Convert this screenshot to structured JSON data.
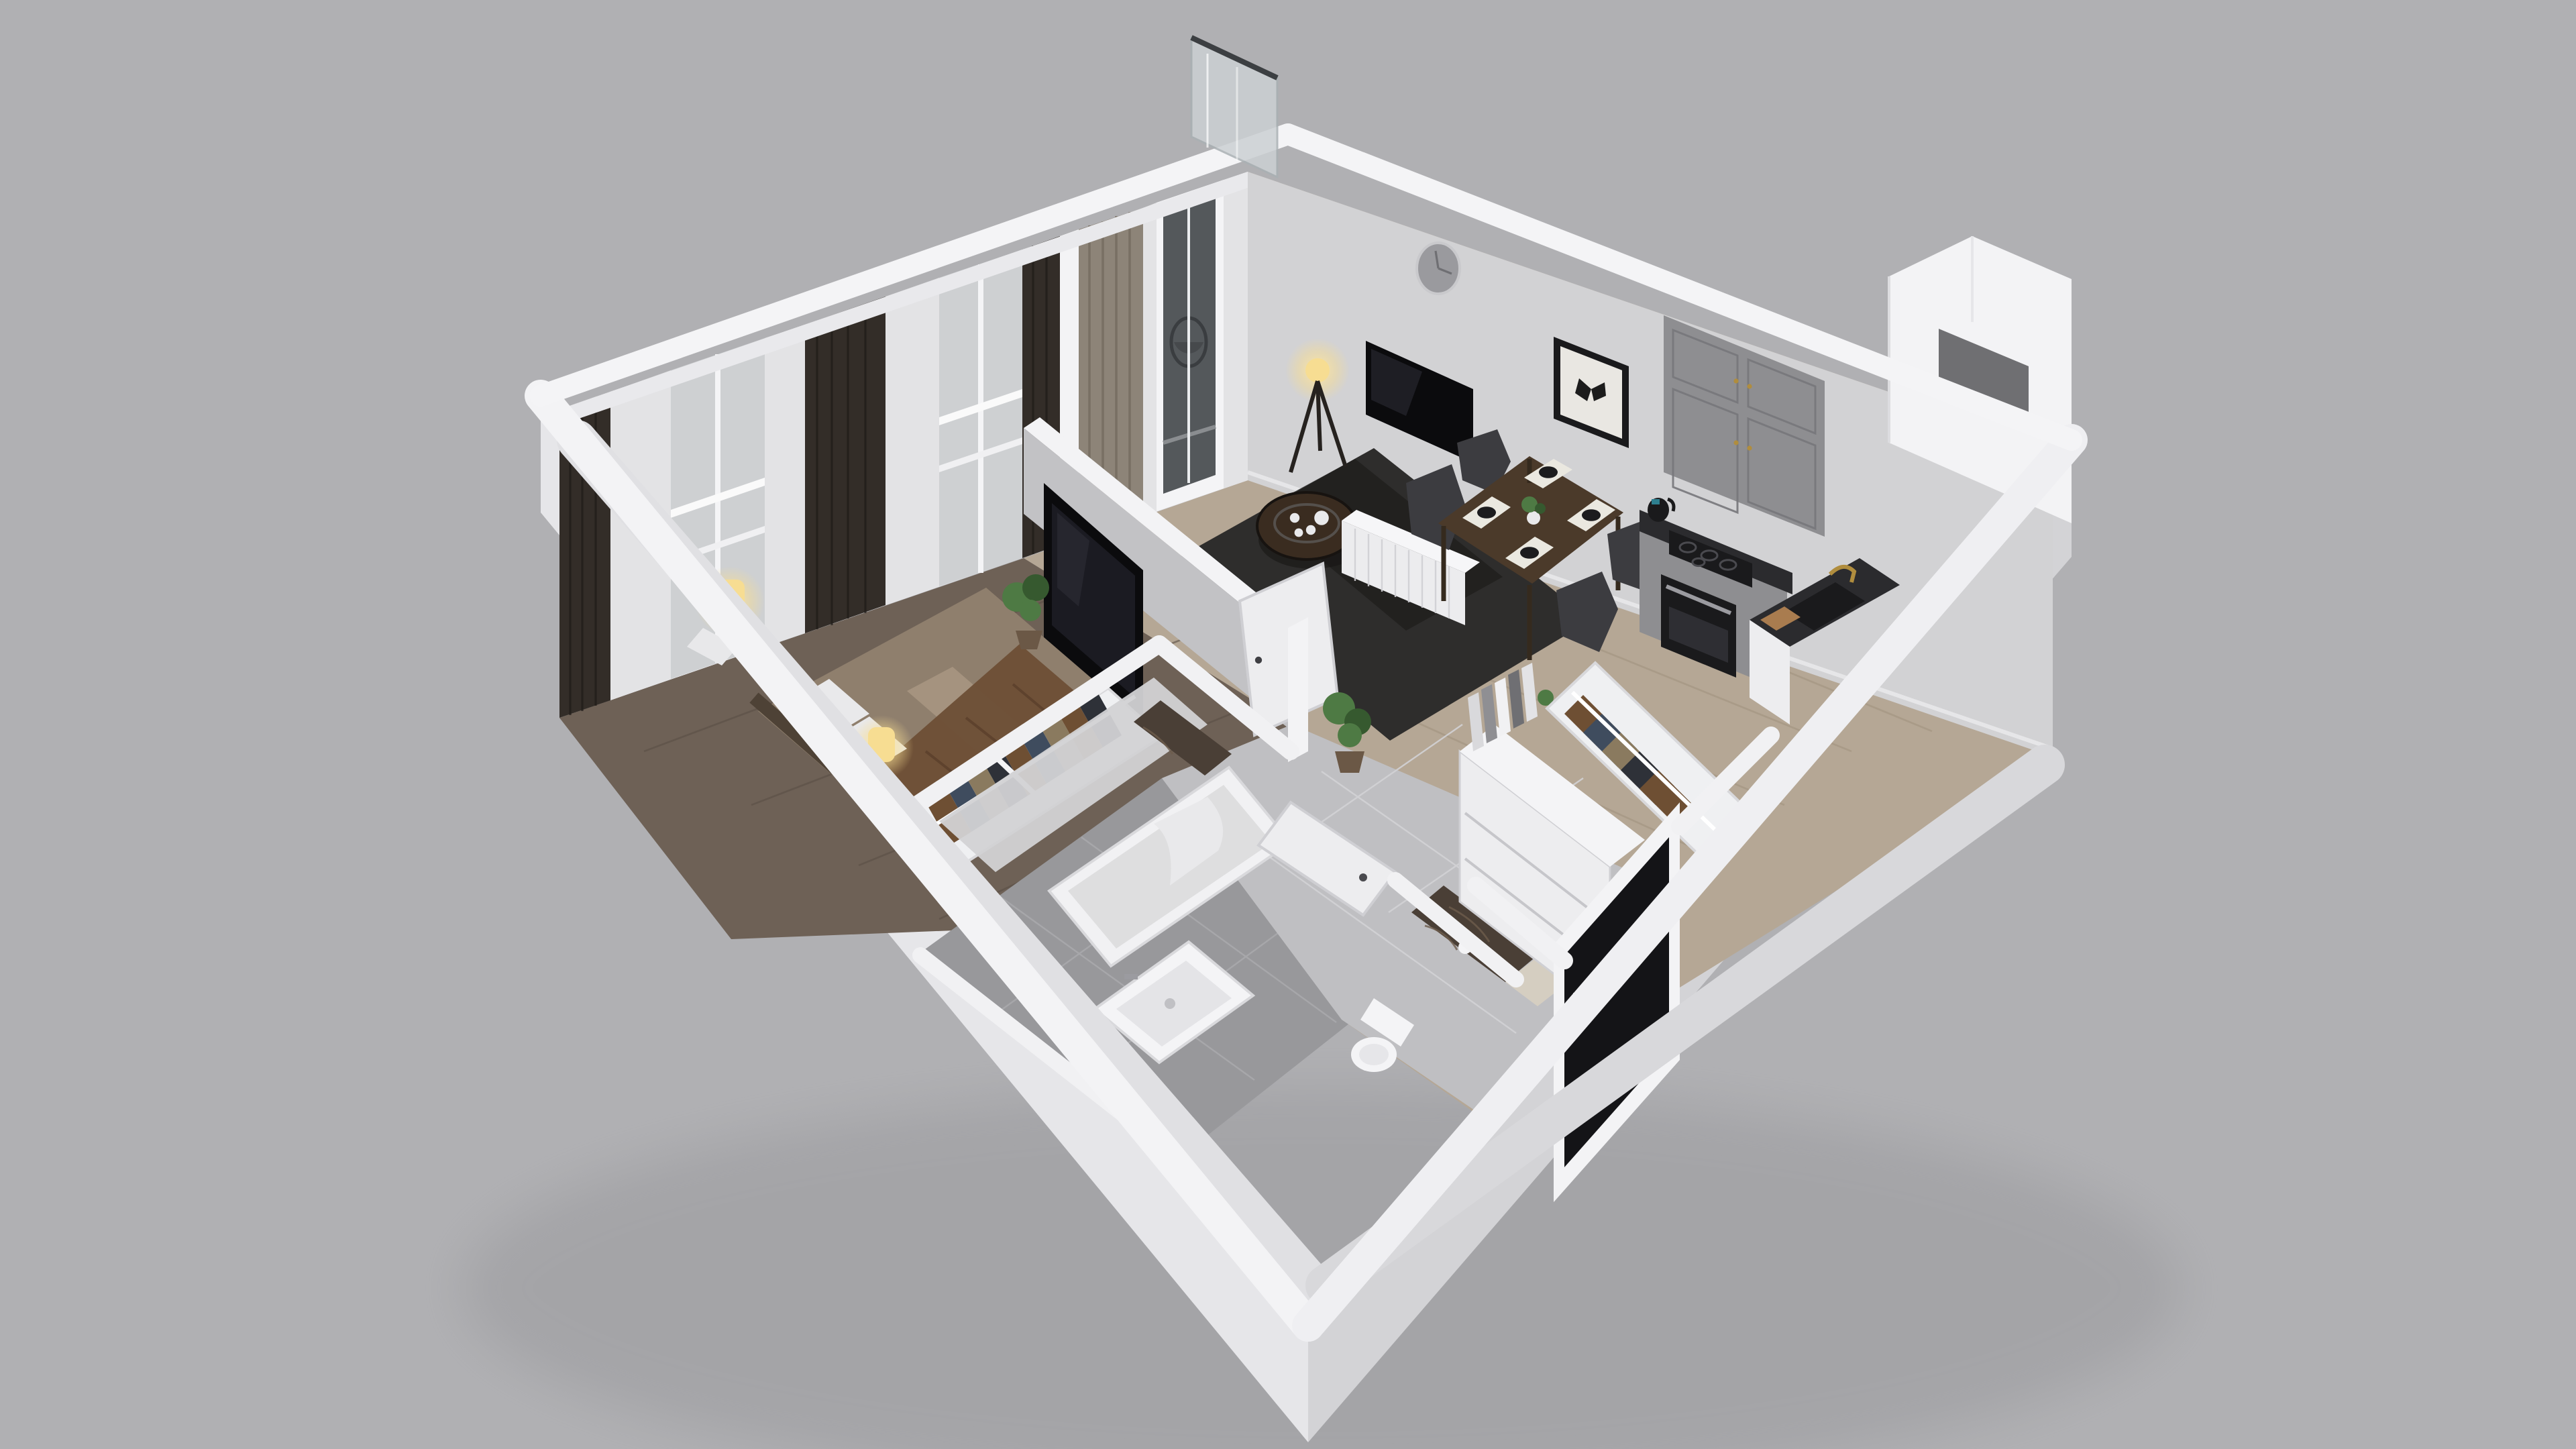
{
  "scene": {
    "title": "3D isometric cutaway floor plan of a one-bedroom apartment",
    "view": "top-down dimetric architectural render, walls cut away on the near sides",
    "rooms": [
      {
        "name": "living-room",
        "floor": "light oak plank flooring",
        "items": [
          "round silver wall clock",
          "wall-mounted flat TV",
          "white fluted media console",
          "framed black-and-white butterfly print",
          "tripod floor lamp with glowing bulb",
          "dark charcoal shag rug",
          "round black coffee table with tray, teapot and cups",
          "walnut dining table",
          "four dark upholstered dining chairs",
          "four white placemats with black plates",
          "small white vase with green plant",
          "potted plant",
          "balcony glass door",
          "taupe and sheer curtains"
        ]
      },
      {
        "name": "bedroom",
        "floor": "dark walnut plank flooring",
        "items": [
          "double bed with beige striped bedding",
          "brown throw blanket",
          "white pillows",
          "dark headboard",
          "two glowing cylinder bedside lamps",
          "white nightstands",
          "black media panel with TV on low partition wall",
          "open wardrobe rail with hanging clothes",
          "potted monstera plant",
          "floor-to-ceiling windows",
          "dark blackout curtains and white sheers"
        ]
      },
      {
        "name": "kitchen",
        "floor": "light oak plank flooring",
        "items": [
          "gray shaker upper cabinets with brass pulls",
          "gray base cabinets",
          "built-in oven",
          "black four-zone cooktop",
          "black kettle",
          "dark stone countertop",
          "black composite sink with brass faucet",
          "wooden cutting board",
          "utensil crock"
        ]
      },
      {
        "name": "bathroom",
        "floor": "gray ceramic tile",
        "items": [
          "white bathtub",
          "white washbasin with chrome tap",
          "toilet",
          "toilet paper holder",
          "dark marble accent wall",
          "light travertine wall band",
          "gray marble shower wall tiles",
          "white door ajar"
        ]
      },
      {
        "name": "hallway",
        "floor": "light gray tile",
        "items": [
          "white wardrobe cabinet with drawers",
          "open clothes rails with hanging garments",
          "books and binders on shelf",
          "small decorative plant",
          "black entrance door with silver handle"
        ]
      },
      {
        "name": "balcony",
        "items": [
          "frosted glass privacy screen",
          "hanging rattan egg chair",
          "wood decking"
        ]
      },
      {
        "name": "exterior",
        "items": [
          "white cut-away perimeter walls",
          "ventilation shaft niche at east corner",
          "soft drop shadow on gray backdrop"
        ]
      }
    ],
    "palette": {
      "background": "#b0b0b3",
      "bgShade": "#a7a7aa",
      "wallWhite": "#f3f3f5",
      "wallFace": "#e8e8eb",
      "extSW": "#e6e6e9",
      "extSE": "#d3d3d6",
      "intWall": "#d2d2d4",
      "intWallDark": "#c2c2c5",
      "livFloor": "#b5a795",
      "livFloorLine": "#a1927e",
      "bedFloor": "#6e6156",
      "bedFloorLine": "#5b5046",
      "bathFloor": "#98989b",
      "hallFloor": "#bfbfc2",
      "curtainDark": "#332d28",
      "curtainTaupe": "#8d8478",
      "sheer": "#e3e3e5",
      "glass": "#b4b8bb",
      "doorGlass": "#54585b",
      "balconyGlass": "#ccd0d3",
      "rug": "#2e2d2c",
      "rugDark": "#1f1e1d",
      "tvBlack": "#0b0b0d",
      "consoleWhite": "#ececee",
      "walnut": "#4b3a2a",
      "walnutDark": "#3a2c20",
      "chair": "#3c3c40",
      "placemat": "#eae8e0",
      "plate": "#1c1c1e",
      "plantGreen": "#4e7a44",
      "plantDark": "#36592f",
      "pot": "#6b5846",
      "bedBase": "#8f7f6d",
      "bedStripe": "#a5937f",
      "blanket": "#6d4f37",
      "pillow": "#e9e9eb",
      "headboard": "#4e4236",
      "lampGlow": "#f7dd92",
      "nightstand": "#e8e8ea",
      "closetWhite": "#eff0f2",
      "clothesA": "#6e4f33",
      "clothesB": "#3f4c5e",
      "clothesC": "#8a7a5f",
      "clothesD": "#2e3138",
      "cabinetGray": "#8e8e91",
      "counter": "#2b2b2e",
      "appliance": "#1a1a1c",
      "brass": "#b08d3e",
      "marbleDark": "#4a3f36",
      "marbleLight": "#d5cec1",
      "tubWhite": "#f1f1f3",
      "tubInner": "#dededf",
      "porcelain": "#f4f4f6",
      "doorWhite": "#ededef",
      "doorBlack": "#141417",
      "clockFace": "#9a9a9e",
      "artFrame": "#1a1a1c",
      "artPaper": "#e9e7e2",
      "butterfly": "#1c1c1c",
      "shaftDark": "#6f6f72"
    }
  }
}
